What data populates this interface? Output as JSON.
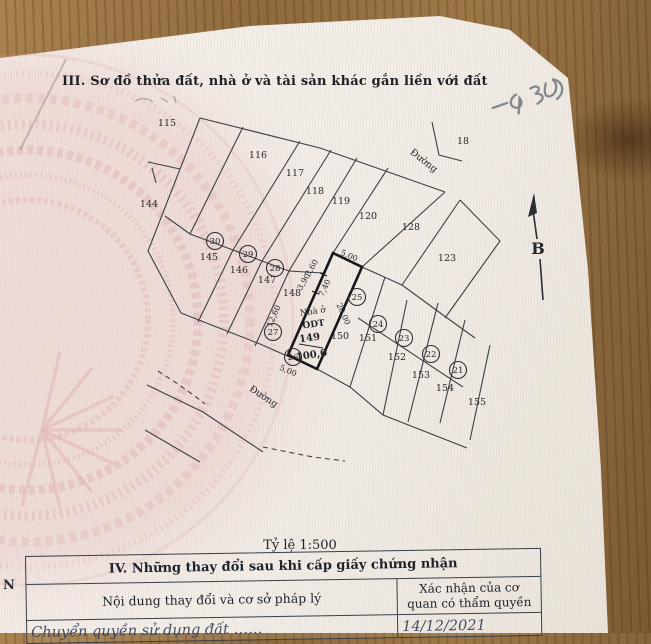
{
  "document": {
    "section3_title": "III. Sơ đồ thửa đất, nhà ở và tài sản khác gắn liền với đất",
    "scale_label": "Tỷ lệ 1:500",
    "margin_letter": "N",
    "section4": {
      "title": "IV. Những thay đổi sau khi cấp giấy chứng nhận",
      "col1_header": "Nội dung thay đổi và cơ sở pháp lý",
      "col2_header": "Xác nhận của cơ quan có thẩm quyền",
      "row1_content": "Chuyển quyền sử dụng đất ……",
      "row1_confirm": "14/12/2021"
    }
  },
  "map": {
    "north_label": "B",
    "subject_parcel": {
      "use_line1": "Nhà ở",
      "use_line2": "ODT",
      "number": "149",
      "area": "100,0"
    },
    "road_labels": [
      {
        "t": "Đường",
        "x": 422,
        "y": 163,
        "r": 38
      },
      {
        "t": "Đường",
        "x": 262,
        "y": 399,
        "r": 33
      }
    ],
    "parcel_labels": [
      {
        "t": "115",
        "x": 167,
        "y": 126
      },
      {
        "t": "144",
        "x": 149,
        "y": 207
      },
      {
        "t": "116",
        "x": 258,
        "y": 158
      },
      {
        "t": "117",
        "x": 295,
        "y": 176
      },
      {
        "t": "118",
        "x": 315,
        "y": 194
      },
      {
        "t": "119",
        "x": 341,
        "y": 204
      },
      {
        "t": "120",
        "x": 368,
        "y": 219
      },
      {
        "t": "128",
        "x": 411,
        "y": 230
      },
      {
        "t": "123",
        "x": 447,
        "y": 261
      },
      {
        "t": "18",
        "x": 463,
        "y": 144
      },
      {
        "t": "145",
        "x": 209,
        "y": 260
      },
      {
        "t": "146",
        "x": 239,
        "y": 273
      },
      {
        "t": "147",
        "x": 267,
        "y": 283
      },
      {
        "t": "148",
        "x": 292,
        "y": 296
      },
      {
        "t": "150",
        "x": 340,
        "y": 339
      },
      {
        "t": "151",
        "x": 368,
        "y": 341
      },
      {
        "t": "152",
        "x": 397,
        "y": 360
      },
      {
        "t": "153",
        "x": 421,
        "y": 378
      },
      {
        "t": "154",
        "x": 445,
        "y": 391
      },
      {
        "t": "155",
        "x": 477,
        "y": 405
      }
    ],
    "circled_numbers": [
      {
        "t": "30",
        "x": 215,
        "y": 241
      },
      {
        "t": "29",
        "x": 248,
        "y": 254
      },
      {
        "t": "28",
        "x": 275,
        "y": 268
      },
      {
        "t": "27",
        "x": 273,
        "y": 332
      },
      {
        "t": "26",
        "x": 293,
        "y": 357
      },
      {
        "t": "25",
        "x": 357,
        "y": 297
      },
      {
        "t": "24",
        "x": 378,
        "y": 324
      },
      {
        "t": "23",
        "x": 404,
        "y": 338
      },
      {
        "t": "22",
        "x": 431,
        "y": 354
      },
      {
        "t": "21",
        "x": 458,
        "y": 370
      }
    ],
    "dimensions": [
      {
        "t": "5,00",
        "x": 348,
        "y": 258,
        "r": 24
      },
      {
        "t": "20,00",
        "x": 341,
        "y": 315,
        "r": 66
      },
      {
        "t": "5,00",
        "x": 287,
        "y": 373,
        "r": 24
      },
      {
        "t": "12,60",
        "x": 276,
        "y": 317,
        "r": -66
      },
      {
        "t": "7,40",
        "x": 327,
        "y": 289,
        "r": -66
      },
      {
        "t": "3,90",
        "x": 306,
        "y": 283,
        "r": -60
      },
      {
        "t": "3,60",
        "x": 314,
        "y": 269,
        "r": -60
      }
    ]
  }
}
